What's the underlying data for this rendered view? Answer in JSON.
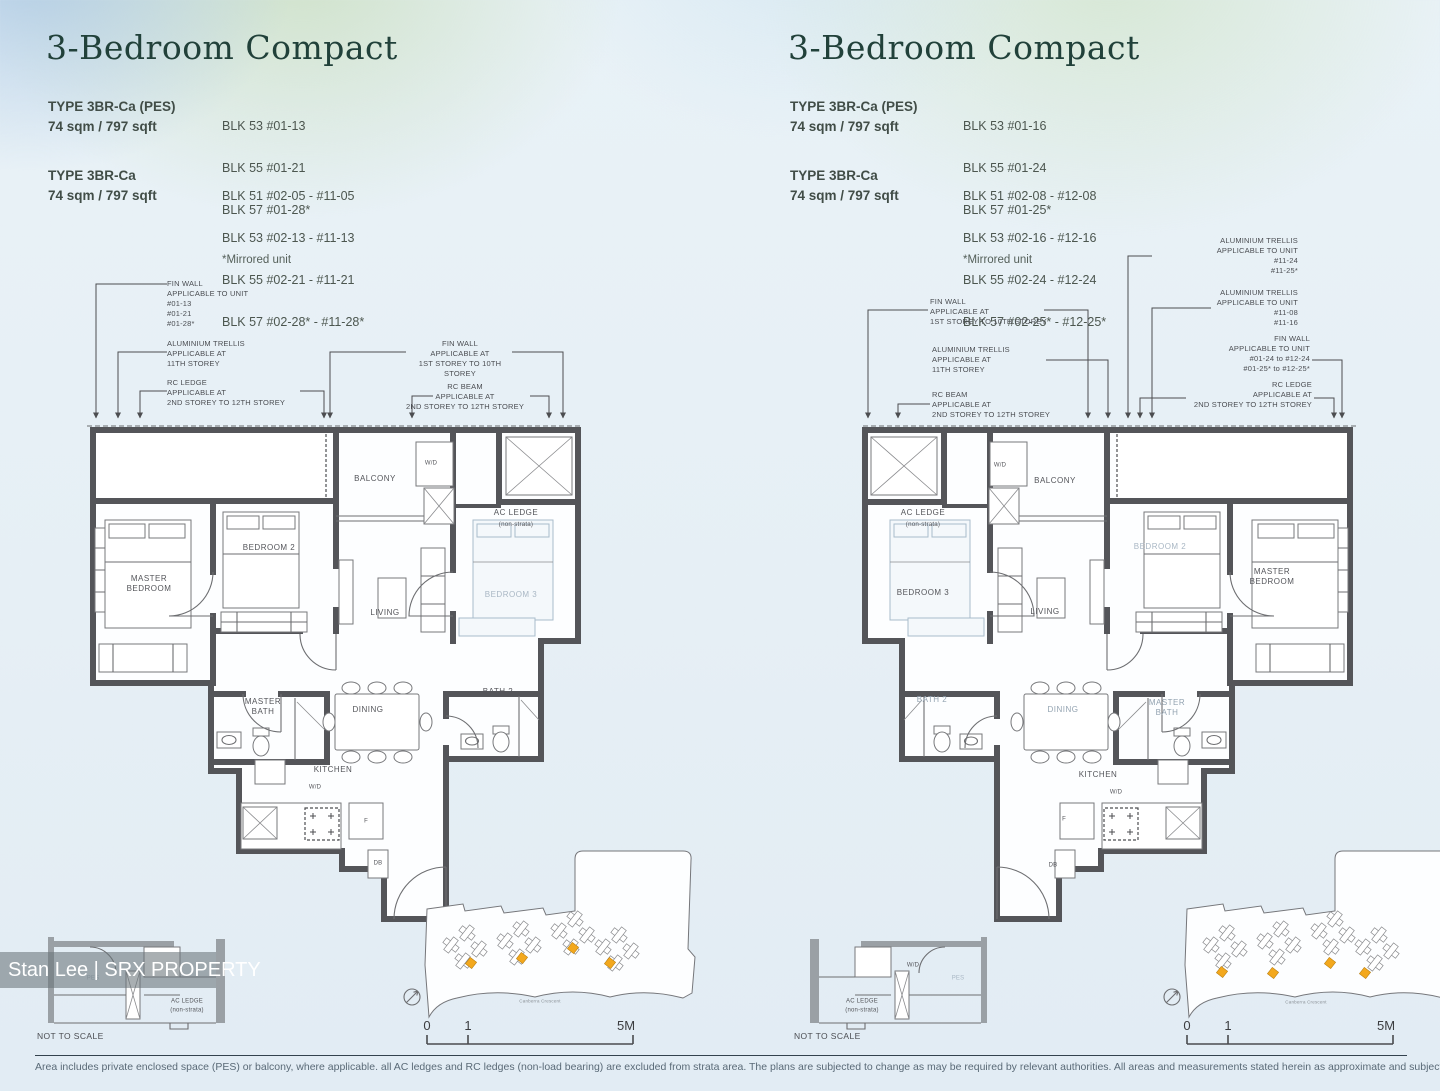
{
  "watermark": "Stan Lee | SRX PROPERTY",
  "disclaimer": "Area includes private enclosed space (PES) or balcony, where applicable. all AC ledges and RC ledges (non-load bearing) are excluded from strata area. The plans are subjected to change as may be required by relevant authorities. All areas and measurements stated herein as approximate and subject to final survey.",
  "panels": [
    {
      "title": "3-Bedroom Compact",
      "types": [
        {
          "name": "TYPE 3BR-Ca (PES)",
          "area": "74 sqm / 797 sqft",
          "blocks": [
            "BLK 53 #01-13",
            "BLK 55 #01-21",
            "BLK 57 #01-28*"
          ]
        },
        {
          "name": "TYPE 3BR-Ca",
          "area": "74 sqm / 797 sqft",
          "blocks": [
            "BLK 51 #02-05 - #11-05",
            "BLK 53 #02-13 - #11-13",
            "BLK 55 #02-21 - #11-21",
            "BLK 57 #02-28* - #11-28*"
          ]
        }
      ],
      "mirror_note": "*Mirrored unit",
      "annotations": [
        {
          "id": "fin-wall-unit",
          "lines": [
            "FIN WALL",
            "APPLICABLE TO UNIT",
            "#01-13",
            "#01-21",
            "#01-28*"
          ]
        },
        {
          "id": "aluminium-trellis",
          "lines": [
            "ALUMINIUM TRELLIS",
            "APPLICABLE AT",
            "11TH STOREY"
          ]
        },
        {
          "id": "rc-ledge",
          "lines": [
            "RC LEDGE",
            "APPLICABLE AT",
            "2ND STOREY TO 12TH STOREY"
          ]
        },
        {
          "id": "fin-wall-storey",
          "lines": [
            "FIN WALL",
            "APPLICABLE AT",
            "1ST STOREY TO 10TH STOREY"
          ]
        },
        {
          "id": "rc-beam",
          "lines": [
            "RC BEAM",
            "APPLICABLE AT",
            "2ND STOREY TO 12TH STOREY"
          ]
        }
      ],
      "rooms": {
        "master_bedroom": "MASTER\nBEDROOM",
        "bedroom2": "BEDROOM 2",
        "bedroom3": "BEDROOM 3",
        "balcony": "BALCONY",
        "wd": "W/D",
        "ac_ledge": "AC LEDGE",
        "ac_ledge_sub": "(non-strata)",
        "living": "LIVING",
        "master_bath": "MASTER\nBATH",
        "dining": "DINING",
        "bath2": "BATH 2",
        "kitchen": "KITCHEN",
        "wd_kitchen": "W/D",
        "fridge": "F",
        "db": "DB"
      },
      "section_labels": [
        "PES",
        "AC LEDGE",
        "(non-strata)"
      ],
      "not_to_scale": "NOT TO SCALE",
      "scale_bar": {
        "zero": "0",
        "one": "1",
        "five": "5M"
      },
      "street": "Canberra Crescent"
    },
    {
      "title": "3-Bedroom Compact",
      "types": [
        {
          "name": "TYPE 3BR-Ca (PES)",
          "area": "74 sqm / 797 sqft",
          "blocks": [
            "BLK 53 #01-16",
            "BLK 55 #01-24",
            "BLK 57 #01-25*"
          ]
        },
        {
          "name": "TYPE 3BR-Ca",
          "area": "74 sqm / 797 sqft",
          "blocks": [
            "BLK 51 #02-08 - #12-08",
            "BLK 53 #02-16 - #12-16",
            "BLK 55 #02-24 - #12-24",
            "BLK 57 #02-25* - #12-25*"
          ]
        }
      ],
      "mirror_note": "*Mirrored unit",
      "annotations": [
        {
          "id": "fin-wall-storey",
          "lines": [
            "FIN WALL",
            "APPLICABLE AT",
            "1ST STOREY TO 10TH STOREY"
          ]
        },
        {
          "id": "aluminium-trellis",
          "lines": [
            "ALUMINIUM TRELLIS",
            "APPLICABLE AT",
            "11TH STOREY"
          ]
        },
        {
          "id": "rc-beam",
          "lines": [
            "RC BEAM",
            "APPLICABLE AT",
            "2ND STOREY TO 12TH STOREY"
          ]
        },
        {
          "id": "trellis-unit-a",
          "lines": [
            "ALUMINIUM TRELLIS",
            "APPLICABLE TO UNIT",
            "#11-24",
            "#11-25*"
          ]
        },
        {
          "id": "trellis-unit-b",
          "lines": [
            "ALUMINIUM TRELLIS",
            "APPLICABLE TO UNIT",
            "#11-08",
            "#11-16"
          ]
        },
        {
          "id": "fin-wall-unit",
          "lines": [
            "FIN WALL",
            "APPLICABLE TO UNIT",
            "#01-24 to #12-24",
            "#01-25* to #12-25*"
          ]
        },
        {
          "id": "rc-ledge",
          "lines": [
            "RC LEDGE",
            "APPLICABLE AT",
            "2ND STOREY TO 12TH STOREY"
          ]
        }
      ],
      "rooms": {
        "master_bedroom": "MASTER\nBEDROOM",
        "bedroom2": "BEDROOM 2",
        "bedroom3": "BEDROOM 3",
        "balcony": "BALCONY",
        "wd": "W/D",
        "ac_ledge": "AC LEDGE",
        "ac_ledge_sub": "(non-strata)",
        "living": "LIVING",
        "master_bath": "MASTER\nBATH",
        "dining": "DINING",
        "bath2": "BATH 2",
        "kitchen": "KITCHEN",
        "wd_kitchen": "W/D",
        "fridge": "F",
        "db": "DB"
      },
      "section_labels": [
        "W/D",
        "PES",
        "AC LEDGE",
        "(non-strata)"
      ],
      "not_to_scale": "NOT TO SCALE",
      "scale_bar": {
        "zero": "0",
        "one": "1",
        "five": "5M"
      },
      "street": "Canberra Crescent"
    }
  ]
}
